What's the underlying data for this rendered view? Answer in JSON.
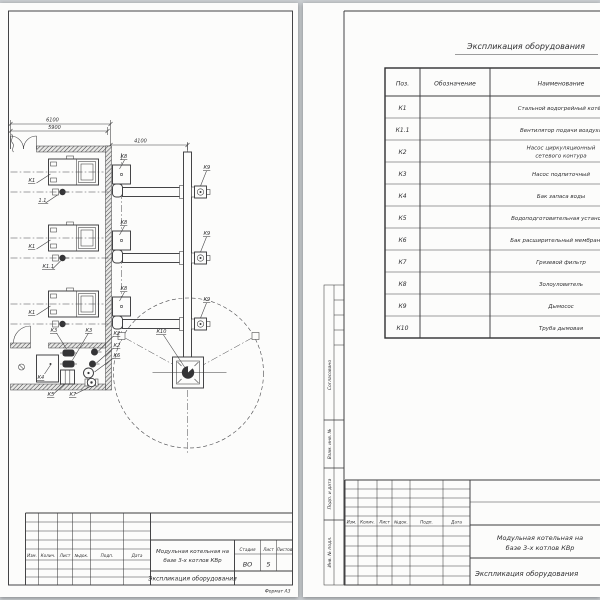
{
  "palette": {
    "background": "#caced1",
    "paper": "#fcfcfb",
    "ink": "#3c3c3e"
  },
  "left_sheet": {
    "dims": {
      "d6100": "6100",
      "d5900": "5900",
      "d4100": "4100"
    },
    "labels": [
      {
        "t": "К1",
        "x": 28,
        "y": 179,
        "l": [
          36,
          180,
          50,
          171
        ]
      },
      {
        "t": "1.1",
        "x": 38,
        "y": 199,
        "l": [
          45,
          200,
          57,
          192
        ]
      },
      {
        "t": "К1",
        "x": 28,
        "y": 245,
        "l": [
          36,
          246,
          50,
          237
        ]
      },
      {
        "t": "К1.1",
        "x": 42,
        "y": 265,
        "l": [
          52,
          266,
          60,
          258
        ]
      },
      {
        "t": "К1",
        "x": 28,
        "y": 311,
        "l": [
          36,
          312,
          50,
          303
        ]
      },
      {
        "t": "К8",
        "x": 120,
        "y": 155,
        "l": [
          124,
          157,
          119,
          166
        ]
      },
      {
        "t": "К8",
        "x": 120,
        "y": 221,
        "l": [
          124,
          223,
          119,
          232
        ]
      },
      {
        "t": "К8",
        "x": 120,
        "y": 287,
        "l": [
          124,
          289,
          119,
          298
        ]
      },
      {
        "t": "К9",
        "x": 203,
        "y": 166,
        "l": [
          206,
          168,
          200,
          183
        ]
      },
      {
        "t": "К9",
        "x": 203,
        "y": 232,
        "l": [
          206,
          234,
          200,
          249
        ]
      },
      {
        "t": "К9",
        "x": 203,
        "y": 298,
        "l": [
          206,
          300,
          200,
          315
        ]
      },
      {
        "t": "К10",
        "x": 156,
        "y": 330,
        "l": [
          163,
          332,
          184,
          364
        ]
      },
      {
        "t": "К3",
        "x": 50,
        "y": 329,
        "l": [
          56,
          330,
          66,
          346
        ]
      },
      {
        "t": "К3",
        "x": 85,
        "y": 329,
        "l": [
          88,
          330,
          72,
          357
        ]
      },
      {
        "t": "К2",
        "x": 113,
        "y": 332,
        "l": [
          113,
          333,
          98,
          348
        ]
      },
      {
        "t": "К2",
        "x": 113,
        "y": 344,
        "l": [
          113,
          345,
          96,
          360
        ]
      },
      {
        "t": "К6",
        "x": 113,
        "y": 354,
        "l": [
          113,
          355,
          94,
          369
        ]
      },
      {
        "t": "К4",
        "x": 37,
        "y": 376,
        "l": [
          44,
          371,
          50,
          362
        ]
      },
      {
        "t": "К5",
        "x": 47,
        "y": 393,
        "l": [
          53,
          391,
          64,
          381
        ]
      },
      {
        "t": "К7",
        "x": 69,
        "y": 393,
        "l": [
          75,
          391,
          89,
          384
        ]
      }
    ],
    "title_block": {
      "cols": [
        "Изм.",
        "Колич.",
        "Лист",
        "№док.",
        "Подп.",
        "Дата"
      ],
      "project_l1": "Модульная котельная на",
      "project_l2": "базе 3-х котлов КВр",
      "doc_title": "Экспликация оборудования",
      "stage_label": "Стадия",
      "sheet_label": "Лист",
      "sheets_label": "Листов",
      "stage": "ВО",
      "sheet_no": "5",
      "sheets": "",
      "format_note": "Формат А3"
    }
  },
  "right_sheet": {
    "spec_title": "Экспликация оборудования",
    "table": {
      "headers": [
        "Поз.",
        "Обозначение",
        "Наименование"
      ],
      "rows": [
        {
          "pos": "К1",
          "name": "Стальной водогрейный котёл"
        },
        {
          "pos": "К1.1",
          "name": "Вентилятор подачи воздуха"
        },
        {
          "pos": "К2",
          "name": "Насос циркуляционный\nсетевого контура"
        },
        {
          "pos": "К3",
          "name": "Насос подпиточный"
        },
        {
          "pos": "К4",
          "name": "Бак запаса воды"
        },
        {
          "pos": "К5",
          "name": "Водоподготовительная установка"
        },
        {
          "pos": "К6",
          "name": "Бак расширительный мембранный"
        },
        {
          "pos": "К7",
          "name": "Грязевой фильтр"
        },
        {
          "pos": "К8",
          "name": "Золоуловитель"
        },
        {
          "pos": "К9",
          "name": "Дымосос"
        },
        {
          "pos": "К10",
          "name": "Труба дымовая"
        }
      ]
    },
    "side_stamp": [
      "Согласовано",
      "Взам. инв. №",
      "Подп. и дата",
      "Инв. № подл."
    ],
    "title_block": {
      "cols": [
        "Изм.",
        "Колич.",
        "Лист",
        "№док.",
        "Подп.",
        "Дата"
      ],
      "project_l1": "Модульная котельная на",
      "project_l2": "базе 3-х котлов КВр",
      "doc_title": "Экспликация оборудования"
    }
  }
}
